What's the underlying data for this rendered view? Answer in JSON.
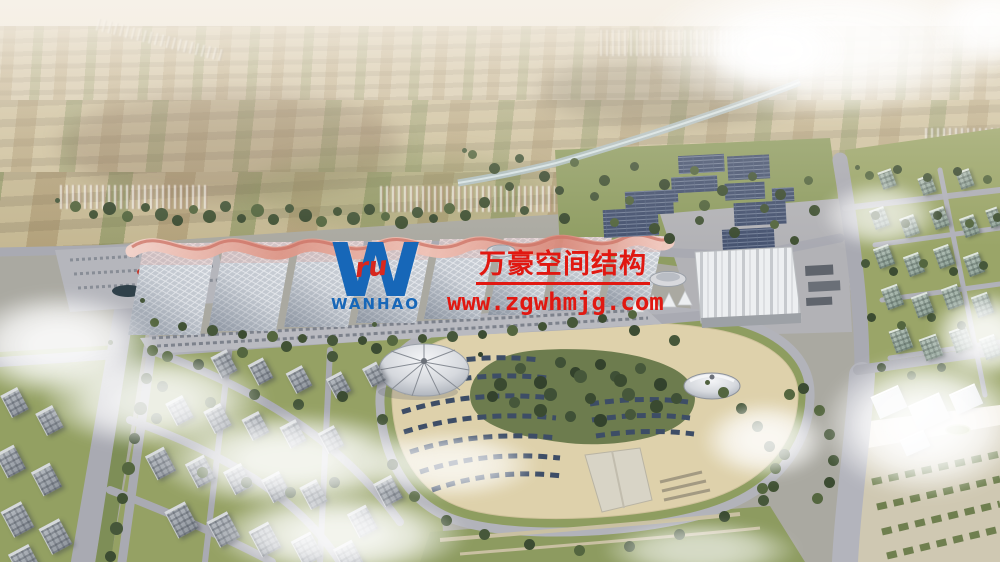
{
  "watermark": {
    "logo": {
      "monogram": "W",
      "glyph": "ru",
      "name": "WANHAO"
    },
    "company_cn": "万豪空间结构",
    "url": "www.zgwhmjg.com",
    "colors": {
      "red": "#e11811",
      "blue": "#1767b8"
    }
  },
  "scene": {
    "palette": {
      "sky_haze": "#f5f0e8",
      "farmland": "#cfc29f",
      "trees": "#46573a",
      "road": "#a9aab2",
      "gridshell_roof": "#ccd1d8",
      "canopy_pink": "#e3a292",
      "solar_panel": "#465370",
      "plaza_beige": "#ded1ab",
      "water": "#b6c7cc",
      "building_grey": "#9aa0a8",
      "lawn_green": "#8e9d60"
    }
  }
}
